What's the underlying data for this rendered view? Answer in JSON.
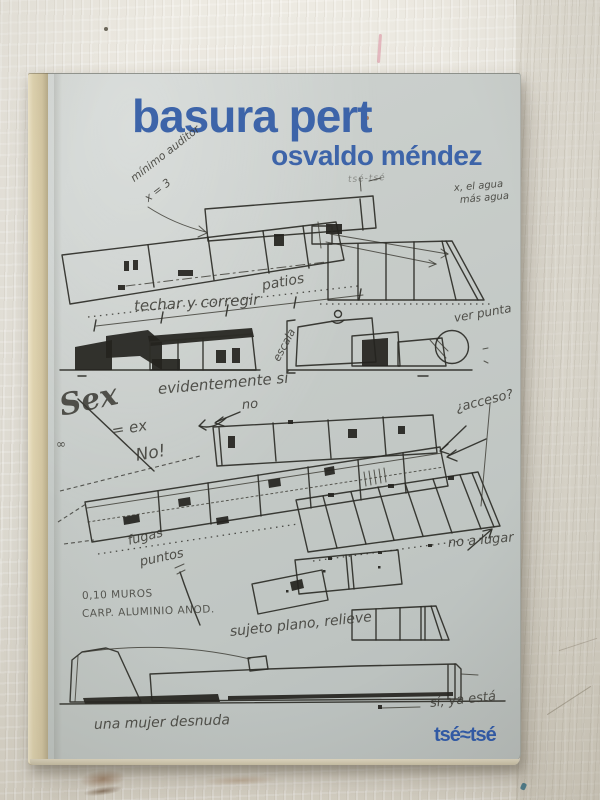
{
  "book": {
    "title": "basura pert",
    "author": "osvaldo méndez",
    "publisher": "tsé≈tsé",
    "annotations": {
      "minimo_auditor": "mínimo auditor",
      "x3": "x = 3",
      "tse_scribble": "tsé-tsé",
      "agua_line1": "x, el agua",
      "agua_line2": "más agua",
      "patios": "patios",
      "techar": "techar y corregir",
      "escala": "escala",
      "ver_punta": "ver punta",
      "evidentemente": "evidentemente sí",
      "no_arrow": "no",
      "sex": "Sex",
      "eq_ex": "= ex",
      "no_excl": "No!",
      "infinity": "∞",
      "acceso": "¿acceso?",
      "fugas": "fugas",
      "puntos": "puntos",
      "no_a_lugar": "no a lugar",
      "muros": "0,10 MUROS",
      "carp": "CARP. ALUMINIO ANOD.",
      "sujeto": "sujeto plano, relieve",
      "mujer": "una mujer desnuda",
      "si_ya_esta": "sí, ya está"
    }
  },
  "colors": {
    "title_blue": "#3d64a9",
    "publisher_blue": "#2d58a8",
    "cover_gray": "#c6cbc8",
    "spine_tan": "#d7caa6",
    "ink": "#2d2c27",
    "wood_white": "#e7e4dc"
  }
}
